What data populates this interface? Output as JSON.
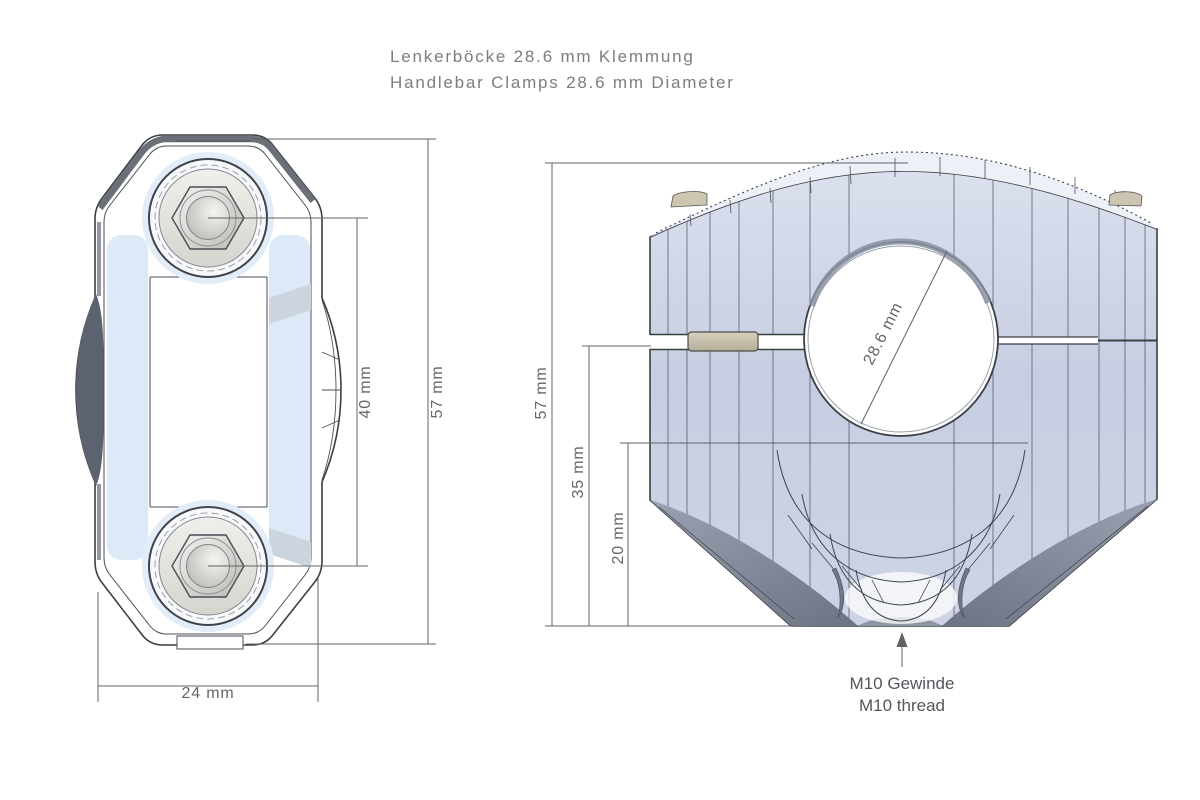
{
  "title": {
    "line1": "Lenkerböcke 28.6 mm Klemmung",
    "line2": "Handlebar Clamps 28.6 mm Diameter"
  },
  "top_view": {
    "dim_bolt_spacing": "40 mm",
    "dim_height": "57 mm",
    "dim_width": "24 mm"
  },
  "front_view": {
    "dim_height": "57 mm",
    "dim_mid": "35 mm",
    "dim_low": "20 mm",
    "dim_bore": "28.6 mm",
    "note_line1": "M10 Gewinde",
    "note_line2": "M10 thread"
  },
  "colors": {
    "outline": "#3a3e45",
    "dimension_line": "#5f6366",
    "dimension_text": "#63666a",
    "title_text": "#7d7d7d",
    "body_blue": "#cdd3e4",
    "panel_blue": "#dce9f7",
    "metal_silver": "#d8d6d0",
    "washer_tan": "#c9c3b0",
    "shadow_gray": "#6f7685"
  }
}
